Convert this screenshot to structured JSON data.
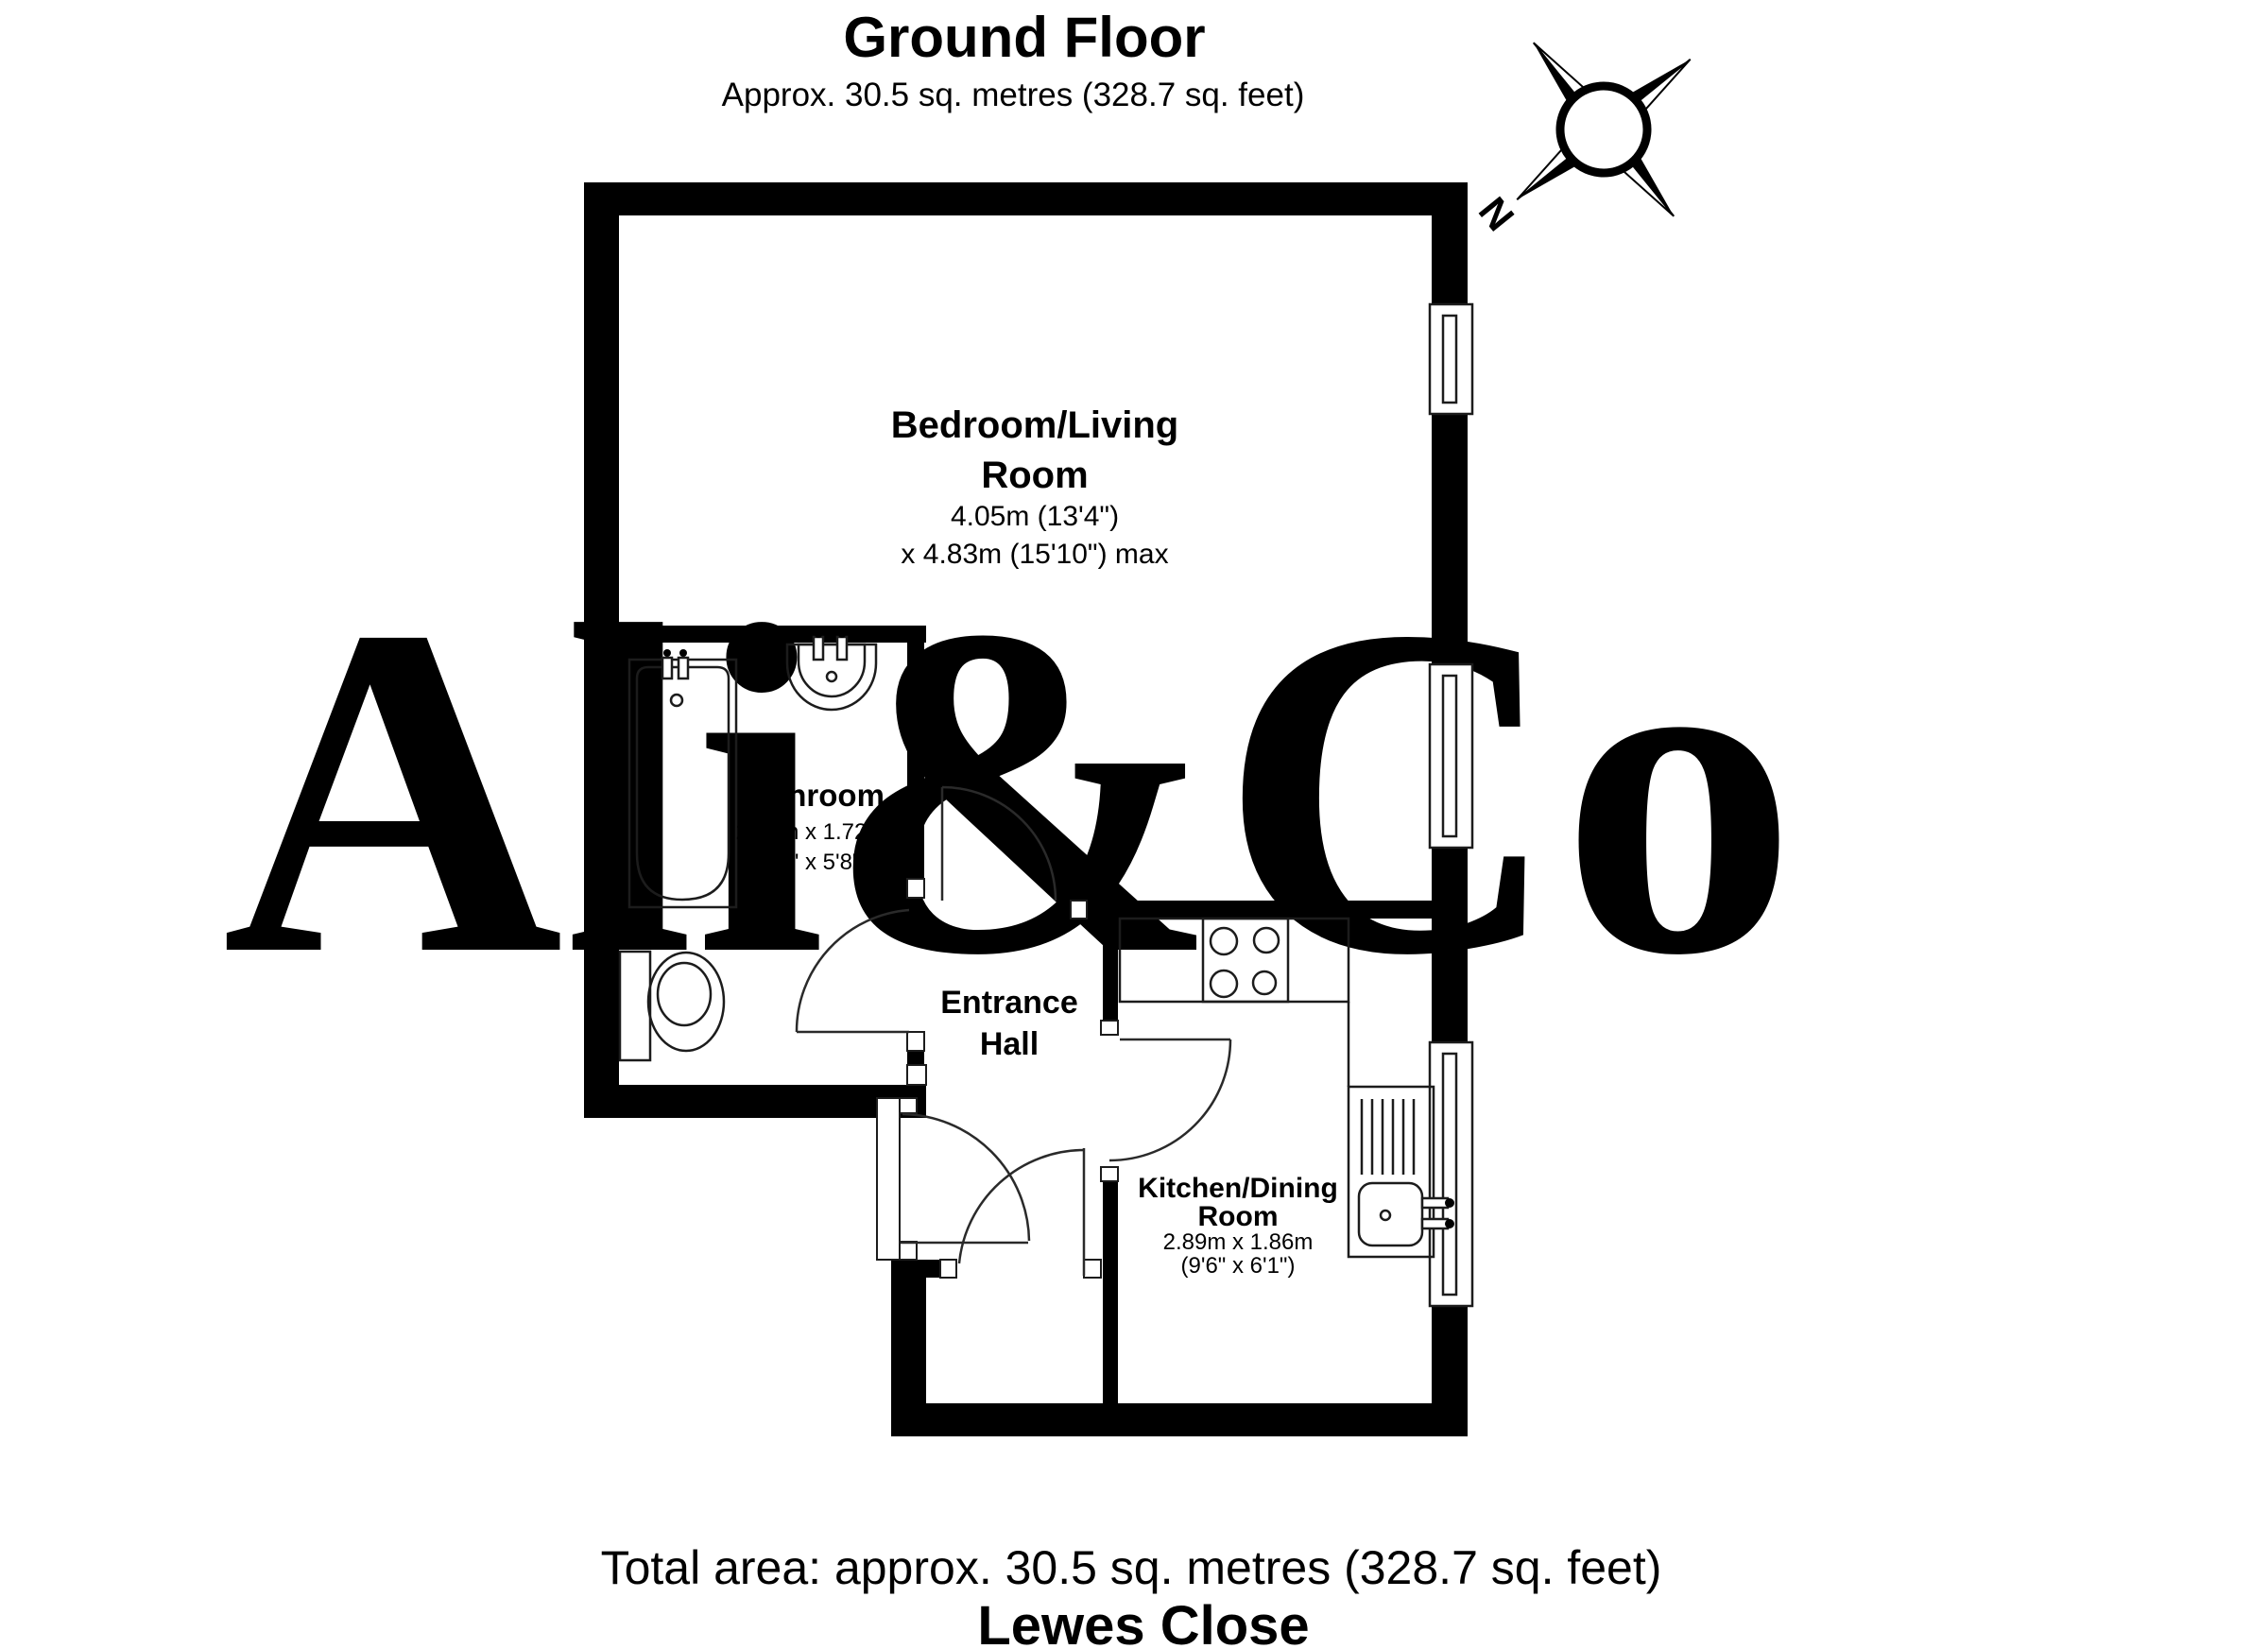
{
  "header": {
    "title": "Ground Floor",
    "subtitle": "Approx. 30.5 sq. metres (328.7 sq. feet)"
  },
  "footer": {
    "total_area": "Total area: approx. 30.5 sq. metres (328.7 sq. feet)",
    "address": "Lewes Close"
  },
  "watermark": {
    "text": "Ali&Co",
    "color": "#e6e8ec"
  },
  "compass": {
    "label": "N"
  },
  "rooms": {
    "bedroom": {
      "name_lines": [
        "Bedroom/Living",
        "Room"
      ],
      "dim_lines": [
        "4.05m (13'4\")",
        "x 4.83m (15'10\") max"
      ]
    },
    "bathroom": {
      "name_lines": [
        "Bathroom"
      ],
      "dim_lines": [
        "2.61m x 1.72m",
        "(8'7\" x 5'8\")"
      ]
    },
    "entrance_hall": {
      "name_lines": [
        "Entrance",
        "Hall"
      ],
      "dim_lines": []
    },
    "kitchen": {
      "name_lines": [
        "Kitchen/Dining",
        "Room"
      ],
      "dim_lines": [
        "2.89m x 1.86m",
        "(9'6\" x 6'1\")"
      ]
    }
  },
  "colors": {
    "wall": "#000000",
    "fixture_line": "#1c1c1c",
    "watermark": "#e6e8ec",
    "background": "#ffffff"
  }
}
